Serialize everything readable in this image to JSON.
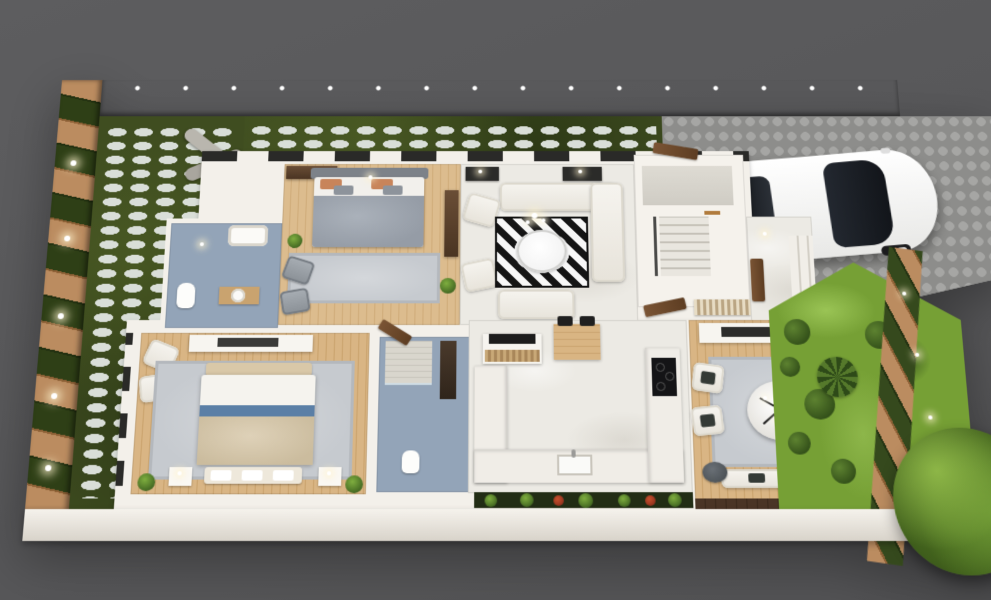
{
  "scene": {
    "type": "3d-cutaway-floor-plan-render",
    "view": "top-down isometric",
    "background_color": "#59595b"
  },
  "palette": {
    "backdrop": "#59595b",
    "cut_walls": "#f3f0ea",
    "marble_floor": "#eceae4",
    "wood_floor": "#dcbc8e",
    "blue_bath_floor": "#93a4b8",
    "front_lawn": "#3f4d20",
    "stepping_stones": "#d9ded8",
    "brick": "#bb8c60",
    "hedge_panel": "#2e3f16",
    "cobblestone": "#979795",
    "garden_grass": "#76a035",
    "garden_path": "#9ac455",
    "car_body": "#f4f4f2",
    "car_glass": "#1c2026",
    "tail_light": "#c22222",
    "accent_blue_bed": "#5b7fa6",
    "pillow_orange": "#c8845a",
    "dark_cushion": "#343a36",
    "rug_black": "#141414",
    "rug_white": "#f7f7f7"
  },
  "outdoor": {
    "boundary_wall": {
      "label": "Striped brick and hedge boundary wall with lights"
    },
    "front_yard": {
      "label": "Front yard lawn with white stepping stones and abstract sculpture"
    },
    "driveway": {
      "label": "Cobblestone driveway"
    },
    "side_garden": {
      "label": "Side garden with shrubs, palm, lawn paths and slatted timber fence with spotlights"
    },
    "planter": {
      "label": "Planter strip with green shrubs and red flowers"
    },
    "tree": {
      "label": "Large tree at rear garden corner"
    }
  },
  "vehicle": {
    "label": "White hatchback car parked on driveway",
    "details": [
      "dark glass roof and windshield",
      "red tail lights",
      "dark wheels"
    ]
  },
  "rooms": [
    {
      "id": "bath1",
      "label": "Bathroom 1 - blue floor, bathtub, toilet, round basin vanity"
    },
    {
      "id": "bedroom2",
      "label": "Bedroom 2 - double bed with grey blanket and orange pillows, grey rug, armchairs, TV cabinet"
    },
    {
      "id": "living",
      "label": "Living room - white corner sofa, two armchairs, loveseat, black and white geometric rug, round glass table, chandelier, console lamps"
    },
    {
      "id": "stairhall",
      "label": "Stair hall - staircase with timber doors"
    },
    {
      "id": "porch",
      "label": "Entry porch - steps, slatted screen, front door"
    },
    {
      "id": "master",
      "label": "Master bedroom - bed with white duvet, blue stripe and beige throw, bench, nightstand lamps, armchairs, dresser"
    },
    {
      "id": "masterbath",
      "label": "Master bathroom - blue floor, tiled shower, vanity, toilet"
    },
    {
      "id": "kitchen",
      "label": "Kitchen - U-shaped marble counter, sink, black cooktop, timber breakfast table with two black chairs, rattan bar island"
    },
    {
      "id": "dining",
      "label": "Dining family room - round marble table, black spoke chandelier, grey rug, bench seating, white sofa with charcoal cushions, side stools"
    }
  ]
}
